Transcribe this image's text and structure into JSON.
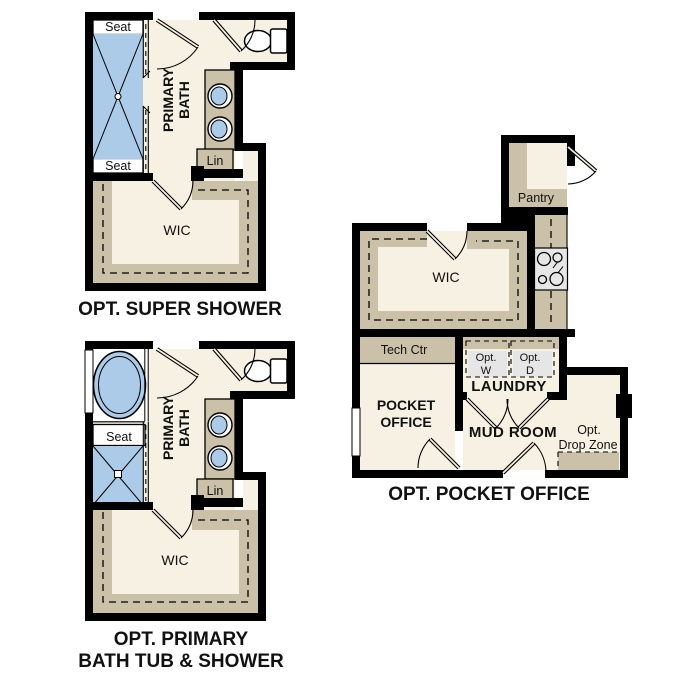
{
  "colors": {
    "background": "#ffffff",
    "wall": "#000000",
    "floor": "#f7f1e3",
    "cabinetry": "#cbc1a8",
    "water_fixture_blue": "#accbe9",
    "appliance_gray": "#e6e6e6"
  },
  "plans": {
    "super_shower": {
      "caption": "OPT. SUPER SHOWER",
      "rooms": {
        "primary_bath_line1": "PRIMARY",
        "primary_bath_line2": "BATH",
        "wic": "WIC"
      },
      "fixtures": {
        "seat_top": "Seat",
        "seat_bottom": "Seat",
        "linen": "Lin"
      }
    },
    "tub_shower": {
      "caption_line1": "OPT. PRIMARY",
      "caption_line2": "BATH TUB & SHOWER",
      "rooms": {
        "primary_bath_line1": "PRIMARY",
        "primary_bath_line2": "BATH",
        "wic": "WIC"
      },
      "fixtures": {
        "seat": "Seat",
        "linen": "Lin"
      }
    },
    "pocket_office": {
      "caption": "OPT. POCKET OFFICE",
      "rooms": {
        "pantry": "Pantry",
        "wic": "WIC",
        "laundry": "LAUNDRY",
        "mud_room": "MUD ROOM",
        "pocket_office_line1": "POCKET",
        "pocket_office_line2": "OFFICE"
      },
      "fixtures": {
        "tech_ctr": "Tech Ctr",
        "washer_line1": "Opt.",
        "washer_line2": "W",
        "dryer_line1": "Opt.",
        "dryer_line2": "D",
        "drop_zone_line1": "Opt.",
        "drop_zone_line2": "Drop Zone"
      }
    }
  }
}
